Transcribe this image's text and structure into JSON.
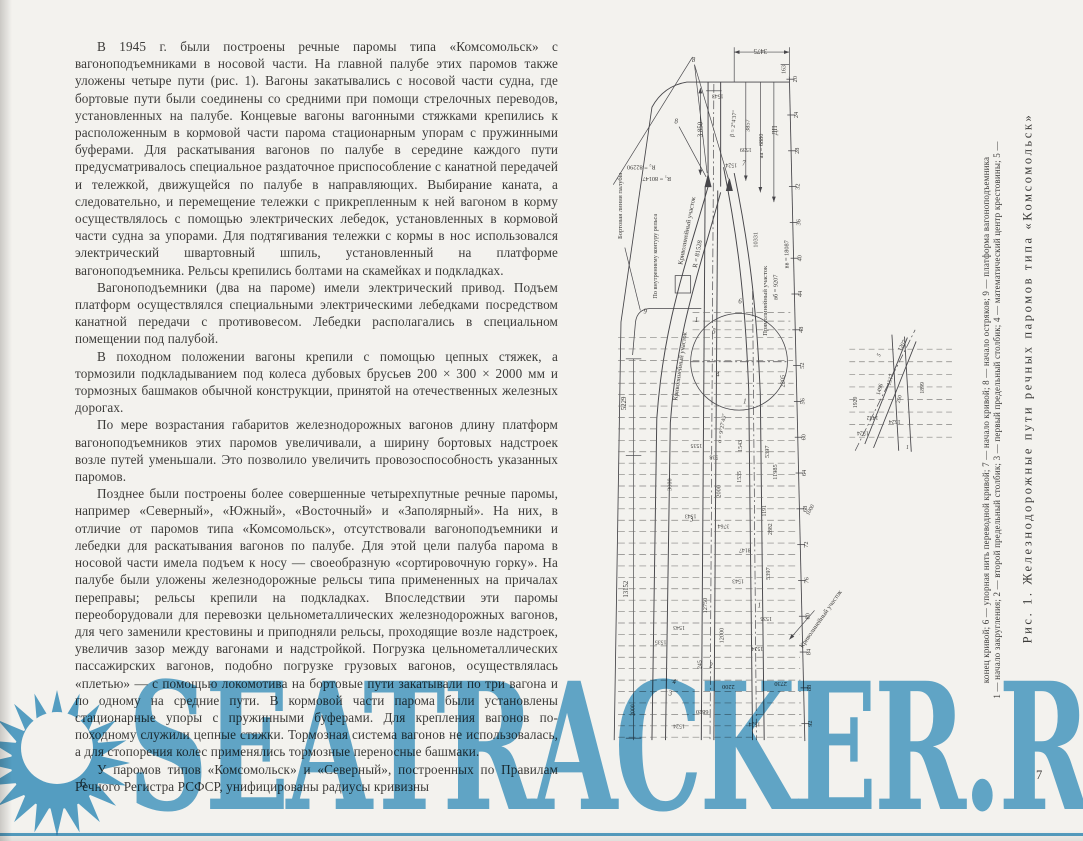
{
  "page": {
    "bg": "#f3f2ee",
    "ink": "#3c3b39",
    "drawing_stroke": "#47464a"
  },
  "left_page": {
    "page_number": "6",
    "paragraphs": [
      "В 1945 г. были построены речные паромы типа «Комсомольск» с вагоноподъемниками в носовой части. На главной палубе этих паромов также уложены четыре пути (рис. 1). Вагоны закатывались с носовой части судна, где бортовые пути были соединены со средними при помощи стрелочных переводов, установленных на палубе. Концевые вагоны вагонными стяжками крепились к расположенным в кормовой части парома стационарным упорам с пружинными буферами. Для раскатывания вагонов по палубе в середине каждого пути предусматривалось специальное раздаточное приспособление с канатной передачей и тележкой, движущейся по палубе в направляющих. Выбирание каната, а следовательно, и перемещение тележки с прикрепленным к ней вагоном в корму осуществлялось с помощью электрических лебедок, установленных в кормовой части судна за упорами. Для подтягивания тележки с кормы в нос использовался электрический швартовный шпиль, установленный на платформе вагоноподъемника. Рельсы крепились болтами на скамейках и подкладках.",
      "Вагоноподъемники (два на пароме) имели электрический привод. Подъем платформ осуществлялся специальными электрическими лебедками посредством канатной передачи с противовесом. Лебедки располагались в специальном помещении под палубой.",
      "В походном положении вагоны крепили с помощью цепных стяжек, а тормозили подкладыванием под колеса дубовых брусьев 200 × 300 × 2000 мм и тормозных башмаков обычной конструкции, принятой на отечественных железных дорогах.",
      "По мере возрастания габаритов железнодорожных вагонов длину платформ вагоноподъемников этих паромов увеличивали, а ширину бортовых надстроек возле путей уменьшали. Это позволило увеличить провозоспособность указанных паромов.",
      "Позднее были построены более совершенные четырехпутные речные паромы, например «Северный», «Южный», «Восточный» и «Заполярный». На них, в отличие от паромов типа «Комсомольск», отсутствовали вагоноподъемники и лебедки для раскатывания вагонов по палубе. Для этой цели палуба парома в носовой части имела подъем к носу — своеобразную «сортировочную горку». На палубе были уложены железнодорожные рельсы типа примененных на причалах переправы; рельсы крепили на подкладках. Впоследствии эти паромы переоборудовали для перевозки цельнометаллических железнодорожных вагонов, для чего заменили крестовины и приподняли рельсы, проходящие возле надстроек, увеличив зазор между вагонами и надстройкой. Погрузка цельнометаллических пассажирских вагонов, подобно погрузке грузовых вагонов, осуществлялась «плетью» — с помощью локомотива на бортовые пути закатывали по три вагона и по одному на средние пути. В кормовой части парома были установлены стационарные упоры с пружинными буферами. Для крепления вагонов по-походному служили цепные стяжки. Тормозная система вагонов не использовалась, а для стопорения колес применялись тормозные переносные башмаки.",
      "У паромов типов «Комсомольск» и «Северный», построенных по Правилам Речного Регистра РСФСР, унифицированы радиусы кривизны"
    ]
  },
  "right_page": {
    "page_number": "7",
    "caption": {
      "title": "Рис. 1. Железнодорожные пути речных паромов типа «Комсомольск»",
      "legend_line1": "1 — начало закругления; 2 — второй предельный столбик; 3 — первый предельный столбик; 4 — математический центр крестовины; 5 —",
      "legend_line2": "конец кривой; 6 — упорная нить переводной кривой; 7 — начало кривой; 8 — начало остряков; 9 — платформа вагоноподъемника"
    },
    "figure": {
      "frame_numbers": [
        "20",
        "24",
        "28",
        "32",
        "36",
        "40",
        "44",
        "48",
        "52",
        "56",
        "60",
        "64",
        "68",
        "72",
        "76",
        "80",
        "84",
        "88",
        "92"
      ],
      "labels": [
        {
          "t": "3475",
          "x": 760,
          "y": 50,
          "r": 180,
          "s": 7
        },
        {
          "t": "163",
          "x": 786,
          "y": 71,
          "r": -90,
          "s": 6
        },
        {
          "t": "1543",
          "x": 716,
          "y": 97,
          "r": 180,
          "s": 6
        },
        {
          "t": "3 850",
          "x": 700,
          "y": 133,
          "r": -90,
          "s": 7
        },
        {
          "t": "β = 2°4′37″",
          "x": 734,
          "y": 127,
          "r": -84,
          "s": 6
        },
        {
          "t": "3857",
          "x": 749,
          "y": 129,
          "r": -90,
          "s": 6.5
        },
        {
          "t": "1539",
          "x": 745,
          "y": 152,
          "r": 180,
          "s": 6
        },
        {
          "t": "1524",
          "x": 730,
          "y": 168,
          "r": 180,
          "s": 6
        },
        {
          "t": "аа = 6880",
          "x": 763,
          "y": 150,
          "r": -90,
          "s": 6.5
        },
        {
          "t": "ДП",
          "x": 777,
          "y": 134,
          "r": -90,
          "s": 7
        },
        {
          "t": "R₂ = 82290",
          "x": 637,
          "y": 170,
          "r": 180,
          "s": 6.5
        },
        {
          "t": "R₁ = 80147",
          "x": 653,
          "y": 182,
          "r": 180,
          "s": 6.5
        },
        {
          "t": "Бортовая линия палубы",
          "x": 617,
          "y": 212,
          "r": -90,
          "s": 6.8
        },
        {
          "t": "По внутреннему контуру рельса",
          "x": 653,
          "y": 264,
          "r": -90,
          "s": 6.4
        },
        {
          "t": "Криволинейный участок",
          "x": 686,
          "y": 238,
          "r": -79,
          "s": 6.8
        },
        {
          "t": "R = 81528",
          "x": 697,
          "y": 262,
          "r": -79,
          "s": 6.8
        },
        {
          "t": "10331",
          "x": 757,
          "y": 247,
          "r": -90,
          "s": 6.5
        },
        {
          "t": "Прямолинейный участок",
          "x": 767,
          "y": 310,
          "r": -90,
          "s": 6.8
        },
        {
          "t": "вб = 9207",
          "x": 778,
          "y": 296,
          "r": -90,
          "s": 6.5
        },
        {
          "t": "вв = 18087",
          "x": 789,
          "y": 262,
          "r": -90,
          "s": 6.5
        },
        {
          "t": "Криволинейный участок",
          "x": 679,
          "y": 378,
          "r": -82,
          "s": 6.8
        },
        {
          "t": "5229",
          "x": 621,
          "y": 416,
          "r": -90,
          "s": 7
        },
        {
          "t": "13152",
          "x": 623,
          "y": 608,
          "r": -90,
          "s": 7
        },
        {
          "t": "α = 9°27′45″",
          "x": 722,
          "y": 442,
          "r": -80,
          "s": 6
        },
        {
          "t": "1535",
          "x": 694,
          "y": 458,
          "r": 180,
          "s": 6
        },
        {
          "t": "538",
          "x": 712,
          "y": 470,
          "r": 180,
          "s": 6
        },
        {
          "t": "1543",
          "x": 741,
          "y": 460,
          "r": -90,
          "s": 6
        },
        {
          "t": "5397",
          "x": 769,
          "y": 466,
          "r": -90,
          "s": 6.5
        },
        {
          "t": "11985",
          "x": 777,
          "y": 487,
          "r": -90,
          "s": 6.5
        },
        {
          "t": "2205",
          "x": 785,
          "y": 393,
          "r": -90,
          "s": 6.5
        },
        {
          "t": "3000",
          "x": 668,
          "y": 500,
          "r": -90,
          "s": 6.5
        },
        {
          "t": "2000",
          "x": 719,
          "y": 507,
          "r": -90,
          "s": 6.5
        },
        {
          "t": "1535",
          "x": 740,
          "y": 492,
          "r": -90,
          "s": 6
        },
        {
          "t": "1543",
          "x": 688,
          "y": 531,
          "r": 180,
          "s": 6
        },
        {
          "t": "3764",
          "x": 722,
          "y": 541,
          "r": 180,
          "s": 6
        },
        {
          "t": "1191",
          "x": 766,
          "y": 527,
          "r": -90,
          "s": 6
        },
        {
          "t": "2882",
          "x": 772,
          "y": 546,
          "r": -90,
          "s": 6
        },
        {
          "t": "8147",
          "x": 744,
          "y": 566,
          "r": 180,
          "s": 6
        },
        {
          "t": "5397",
          "x": 770,
          "y": 592,
          "r": -90,
          "s": 6.5
        },
        {
          "t": "1543",
          "x": 737,
          "y": 598,
          "r": 180,
          "s": 6
        },
        {
          "t": "12750",
          "x": 705,
          "y": 625,
          "r": -90,
          "s": 6.5
        },
        {
          "t": "12000",
          "x": 722,
          "y": 656,
          "r": -90,
          "s": 6.5
        },
        {
          "t": "1535",
          "x": 766,
          "y": 637,
          "r": 180,
          "s": 6
        },
        {
          "t": "1524",
          "x": 757,
          "y": 668,
          "r": 180,
          "s": 6
        },
        {
          "t": "245",
          "x": 699,
          "y": 686,
          "r": -90,
          "s": 6
        },
        {
          "t": "2200",
          "x": 727,
          "y": 707,
          "r": 180,
          "s": 6.5
        },
        {
          "t": "2730",
          "x": 781,
          "y": 704,
          "r": 180,
          "s": 6.5
        },
        {
          "t": "6820",
          "x": 700,
          "y": 733,
          "r": 180,
          "s": 6.5
        },
        {
          "t": "1524",
          "x": 676,
          "y": 748,
          "r": 180,
          "s": 6
        },
        {
          "t": "1524",
          "x": 754,
          "y": 746,
          "r": 180,
          "s": 6
        },
        {
          "t": "2000",
          "x": 630,
          "y": 733,
          "r": -90,
          "s": 6
        },
        {
          "t": "1535",
          "x": 657,
          "y": 661,
          "r": 180,
          "s": 6
        },
        {
          "t": "1543",
          "x": 676,
          "y": 646,
          "r": 180,
          "s": 6
        },
        {
          "t": "1000",
          "x": 813,
          "y": 527,
          "r": -60,
          "s": 6
        },
        {
          "t": "Криволинейный участок",
          "x": 824,
          "y": 640,
          "r": -55,
          "s": 6.8
        },
        {
          "t": "8",
          "x": 691,
          "y": 63,
          "r": 0,
          "s": 7,
          "i": 1
        },
        {
          "t": "8",
          "x": 673,
          "y": 127,
          "r": 0,
          "s": 7,
          "i": 1
        },
        {
          "t": "7",
          "x": 743,
          "y": 170,
          "r": 0,
          "s": 7,
          "i": 1
        },
        {
          "t": "9",
          "x": 641,
          "y": 323,
          "r": 0,
          "s": 7,
          "i": 1
        },
        {
          "t": "1",
          "x": 694,
          "y": 332,
          "r": 0,
          "s": 7,
          "i": 1
        },
        {
          "t": "5",
          "x": 712,
          "y": 344,
          "r": 0,
          "s": 7,
          "i": 1
        },
        {
          "t": "6",
          "x": 739,
          "y": 313,
          "r": 0,
          "s": 7,
          "i": 1
        },
        {
          "t": "4",
          "x": 716,
          "y": 388,
          "r": 0,
          "s": 7,
          "i": 1
        },
        {
          "t": "1",
          "x": 744,
          "y": 416,
          "r": 0,
          "s": 7,
          "i": 1
        },
        {
          "t": "3",
          "x": 689,
          "y": 538,
          "r": 0,
          "s": 7,
          "i": 1
        },
        {
          "t": "2",
          "x": 709,
          "y": 689,
          "r": 0,
          "s": 7,
          "i": 1
        },
        {
          "t": "1",
          "x": 759,
          "y": 627,
          "r": 0,
          "s": 7,
          "i": 1
        },
        {
          "t": "4",
          "x": 671,
          "y": 706,
          "r": 0,
          "s": 7,
          "i": 1
        },
        {
          "t": "3",
          "x": 667,
          "y": 718,
          "r": 0,
          "s": 7,
          "i": 1
        },
        {
          "t": "1207",
          "x": 908,
          "y": 357,
          "r": -60,
          "s": 6
        },
        {
          "t": "1920",
          "x": 860,
          "y": 415,
          "r": -90,
          "s": 6
        },
        {
          "t": "1496",
          "x": 885,
          "y": 402,
          "r": -75,
          "s": 6
        },
        {
          "t": "1517",
          "x": 896,
          "y": 392,
          "r": -75,
          "s": 6
        },
        {
          "t": "250",
          "x": 905,
          "y": 412,
          "r": -75,
          "s": 5.5
        },
        {
          "t": "1899",
          "x": 929,
          "y": 400,
          "r": -90,
          "s": 6
        },
        {
          "t": "1432",
          "x": 876,
          "y": 429,
          "r": 180,
          "s": 6
        },
        {
          "t": "1524",
          "x": 899,
          "y": 433,
          "r": 180,
          "s": 6
        },
        {
          "t": "1524",
          "x": 866,
          "y": 445,
          "r": 180,
          "s": 6
        },
        {
          "t": "5",
          "x": 884,
          "y": 367,
          "r": -60,
          "s": 6,
          "i": 1
        },
        {
          "t": "1",
          "x": 912,
          "y": 463,
          "r": 0,
          "s": 6,
          "i": 1
        }
      ]
    }
  },
  "watermark": {
    "text": "SEATRACKER.RU",
    "color": "#58a6cf",
    "logo": "sunburst-icon"
  }
}
